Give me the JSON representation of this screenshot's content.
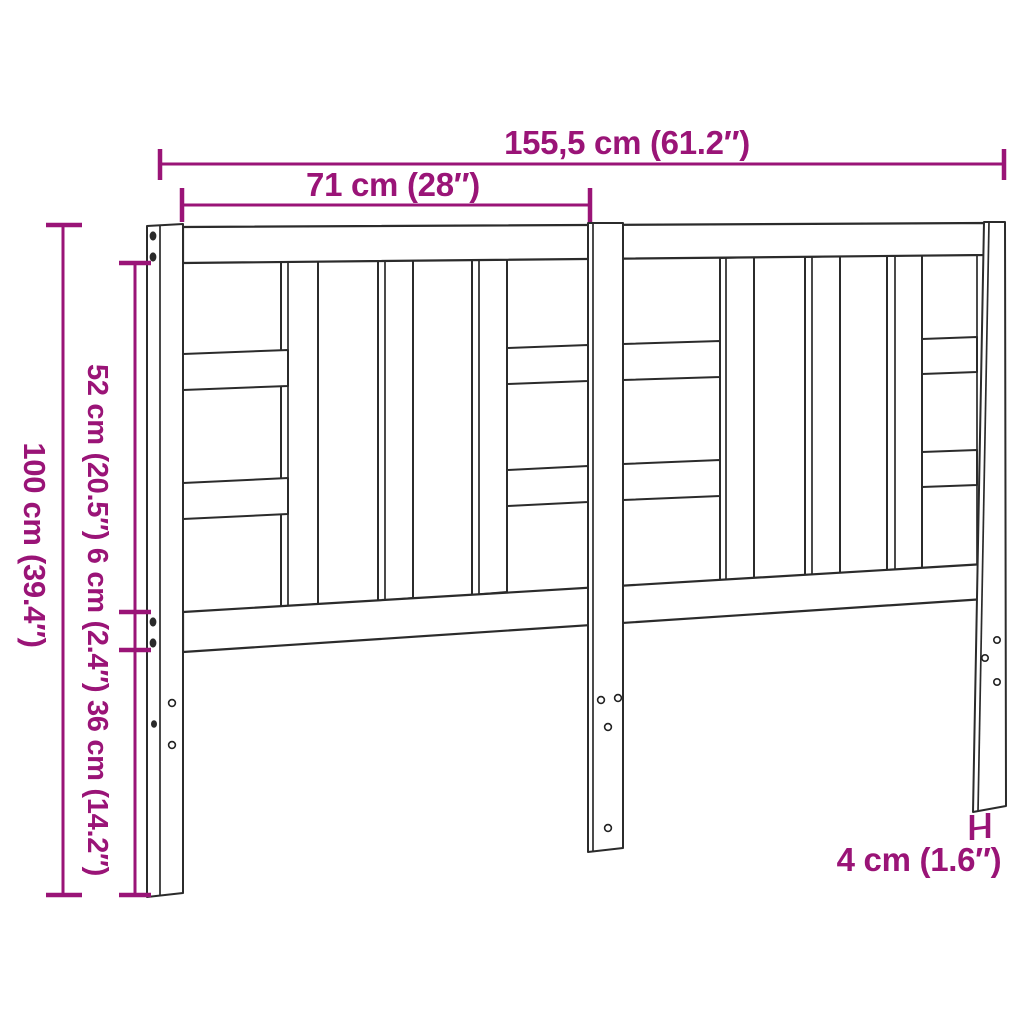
{
  "drawing": {
    "subject": "headboard-technical-line-drawing",
    "colors": {
      "dimension": "#9A1477",
      "line": "#2B2B2B",
      "background": "#FFFFFF"
    },
    "dimensions": {
      "overall_width": "155,5 cm (61.2″)",
      "section_width": "71 cm (28″)",
      "overall_height": "100 cm (39.4″)",
      "side_segments": "52 cm (20.5″) 6 cm (2.4″) 36 cm (14.2″)",
      "leg_depth": "4 cm (1.6″)"
    }
  }
}
